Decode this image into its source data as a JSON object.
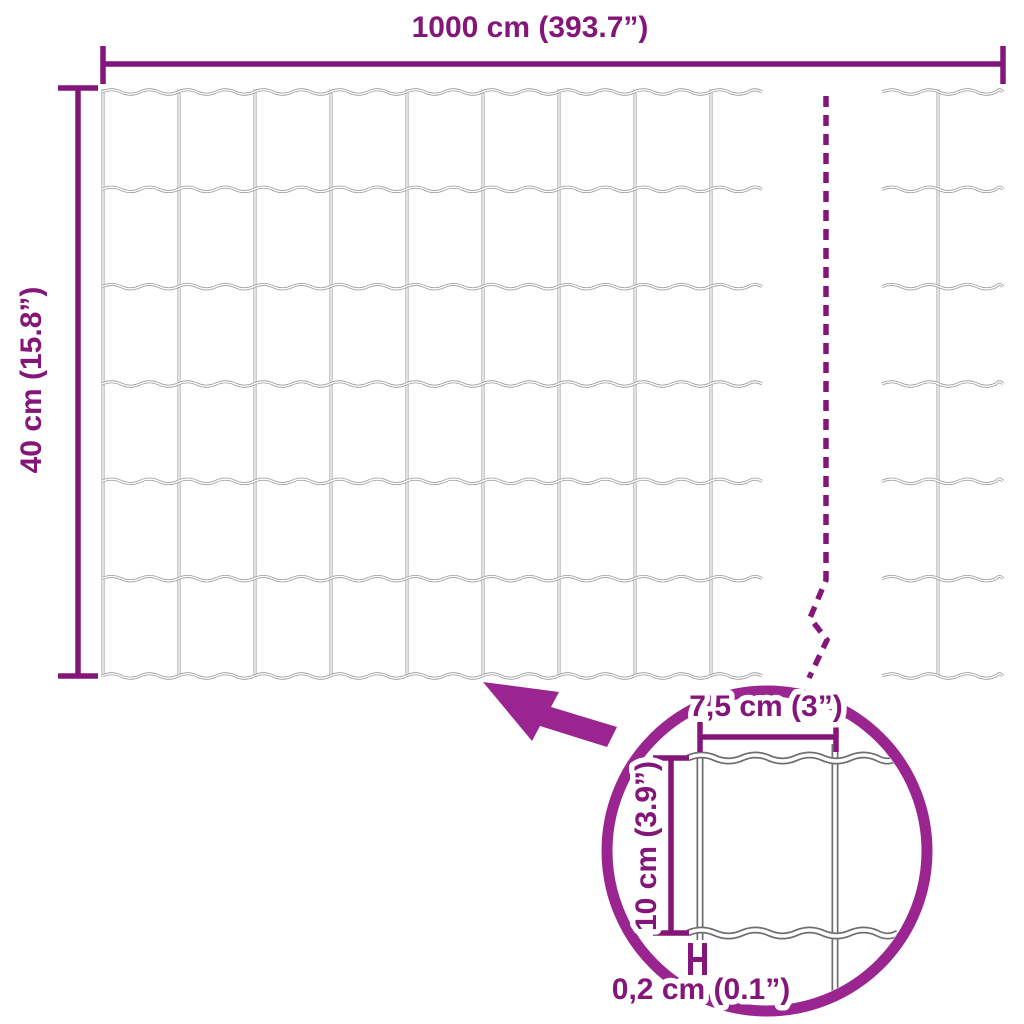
{
  "image": {
    "type": "product-dimension-diagram",
    "subject": "garden wire mesh fence roll with zoom detail of mesh cell"
  },
  "labels": {
    "total_width": "1000 cm (393.7”)",
    "total_height": "40 cm (15.8”)",
    "mesh_width": "7,5 cm (3”)",
    "mesh_height": "10 cm (3.9”)",
    "wire_thickness": "0,2 cm (0.1”)"
  },
  "measurements": {
    "total_width_cm": 1000,
    "total_width_in": 393.7,
    "total_height_cm": 40,
    "total_height_in": 15.8,
    "mesh_width_cm": 7.5,
    "mesh_width_in": 3,
    "mesh_height_cm": 10,
    "mesh_height_in": 3.9,
    "wire_thickness_cm": 0.2,
    "wire_thickness_in": 0.1
  },
  "icons": {
    "arrow": "zoom-arrow-icon",
    "break_line": "fence-continuation-break-line",
    "detail_circle": "zoom-detail-circle"
  },
  "colors": {
    "ink": "#841679",
    "accent": "#9A2490",
    "wire_gray": "#9A9A9A",
    "detail_wire_gray": "#6E6E6E",
    "background": "#FFFFFF"
  }
}
